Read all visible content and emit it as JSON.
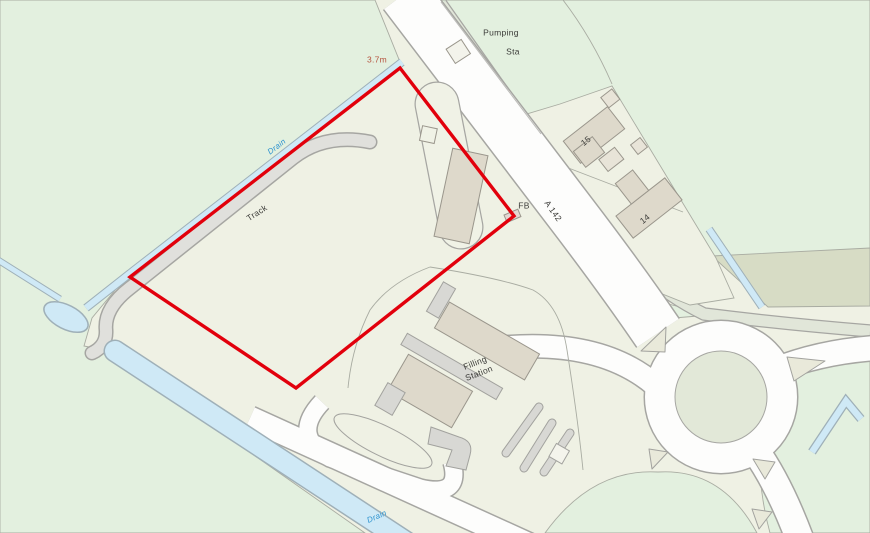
{
  "map": {
    "type": "ordnance-survey-style site plan",
    "labels": [
      {
        "name": "pumping-station-label-line1",
        "text": "Pumping",
        "x": 501,
        "y": 33,
        "rot": 0,
        "cls": "dark"
      },
      {
        "name": "pumping-station-label-line2",
        "text": "Sta",
        "x": 513,
        "y": 52,
        "rot": 0,
        "cls": "dark"
      },
      {
        "name": "spot-height-label",
        "text": "3.7m",
        "x": 377,
        "y": 60,
        "rot": 0,
        "cls": "height"
      },
      {
        "name": "drain-upper-label",
        "text": "Drain",
        "x": 277,
        "y": 147,
        "rot": -37,
        "cls": "water"
      },
      {
        "name": "track-label",
        "text": "Track",
        "x": 257,
        "y": 213,
        "rot": -33,
        "cls": "dark"
      },
      {
        "name": "footbridge-label",
        "text": "FB",
        "x": 524,
        "y": 206,
        "rot": 0,
        "cls": "dark"
      },
      {
        "name": "a142-road-label",
        "text": "A 142",
        "x": 553,
        "y": 211,
        "rot": 55,
        "cls": "dark"
      },
      {
        "name": "house-15-label",
        "text": "15",
        "x": 586,
        "y": 141,
        "rot": -38,
        "cls": "dark"
      },
      {
        "name": "house-14-label",
        "text": "14",
        "x": 645,
        "y": 219,
        "rot": -38,
        "cls": "dark"
      },
      {
        "name": "filling-station-label",
        "text": "Filling\nStation",
        "x": 477,
        "y": 368,
        "rot": -21,
        "cls": "dark"
      },
      {
        "name": "drain-lower-label",
        "text": "Drain",
        "x": 377,
        "y": 517,
        "rot": -24,
        "cls": "water"
      }
    ],
    "colors": {
      "field_green": "#e3f0df",
      "parcel_cream": "#eff1e4",
      "road_white": "#fdfdfc",
      "casing_gray": "#a6a6a2",
      "water_fill": "#cfe9f6",
      "water_label": "#2d93cf",
      "track_fill": "#e0e0dc",
      "building_tan": "#ded9cb",
      "boundary_red": "#e2000c",
      "height_label": "#b5543f",
      "label_dark": "#3b3b38"
    }
  }
}
